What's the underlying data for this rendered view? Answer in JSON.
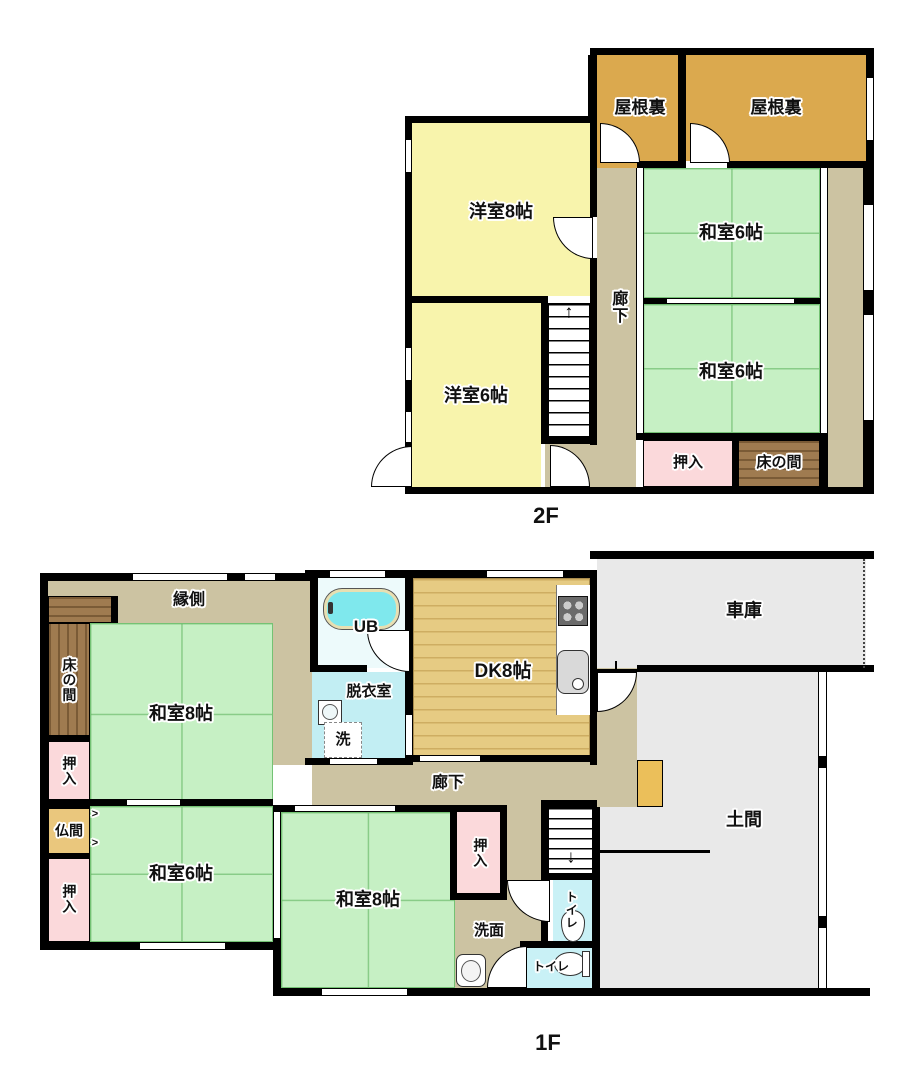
{
  "palette": {
    "wall": "#000000",
    "attic": "#dba94e",
    "western": "#f8f4ac",
    "tatami": "#c6f0c4",
    "corridor": "#ccc3a2",
    "closet": "#fbd9db",
    "tokonoma": "#9f7b50",
    "butsuma": "#eac77d",
    "bath_room": "#edfafb",
    "bathtub": "#7fe8ed",
    "washroom": "#c2eef3",
    "toilet": "#c9f1f6",
    "dk": "#e6cb83",
    "concrete": "#e9e9e9",
    "step": "#ebbf5a",
    "counter": "#ffffff"
  },
  "floor2": {
    "floor_label": "2F",
    "stairs_arrow": "↑",
    "rooms": {
      "attic_left": "屋根裏",
      "attic_right": "屋根裏",
      "western8": "洋室8帖",
      "western6": "洋室6帖",
      "washitsu6_upper": "和室6帖",
      "washitsu6_lower": "和室6帖",
      "corridor": "廊下",
      "oshiire": "押入",
      "tokonoma": "床の間"
    }
  },
  "floor1": {
    "floor_label": "1F",
    "stairs_arrow": "↓",
    "fusuma_arrow": ">",
    "rooms": {
      "engawa": "縁側",
      "tokonoma": "床の間",
      "washitsu8_upper": "和室8帖",
      "oshiire_top": "押入",
      "butsuma": "仏間",
      "oshiire_bottom": "押入",
      "washitsu6": "和室6帖",
      "washitsu8_lower": "和室8帖",
      "unit_bath": "UB",
      "datsuiishitsu": "脱衣室",
      "laundry": "洗",
      "dk": "DK8帖",
      "corridor": "廊下",
      "oshiire_hall": "押入",
      "senmen": "洗面",
      "toilet_upper": "トイレ",
      "toilet_lower": "トイレ",
      "garage": "車庫",
      "doma": "土間"
    }
  }
}
